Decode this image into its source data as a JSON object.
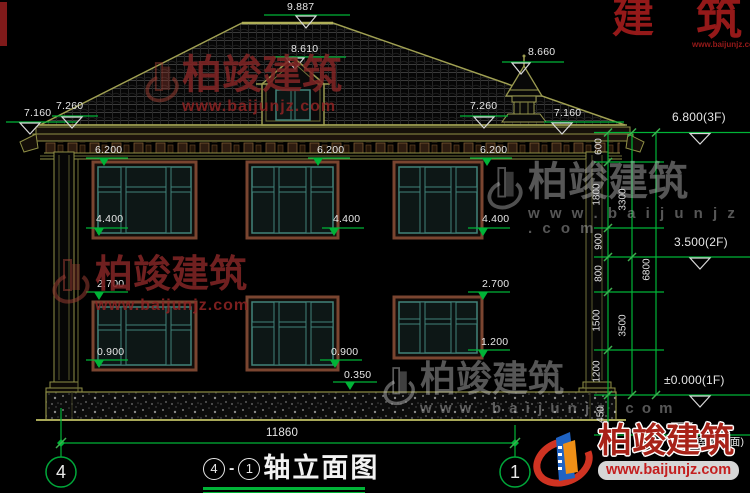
{
  "levels": {
    "ridge": "9.887",
    "dormer": "8.610",
    "turret": "8.660",
    "left_outer": "7.160",
    "left_inner": "7.260",
    "right_inner": "7.260",
    "right_outer": "7.160",
    "f3": "6.800(3F)",
    "f2": "3.500(2F)",
    "f1": "±0.000(1F)",
    "outdoor": "(室外地面)"
  },
  "dims": {
    "head_2f": [
      "6.200",
      "6.200",
      "6.200"
    ],
    "sill_2f": [
      "4.400",
      "4.400",
      "4.400"
    ],
    "head_1f": [
      "2.700",
      "2.700"
    ],
    "sill_1f": [
      "0.900",
      "0.900"
    ],
    "sill_1f_right": "1.200",
    "step": "0.350",
    "total_width": "11860"
  },
  "chain": {
    "outer": [
      "600",
      "1800",
      "900",
      "800",
      "1500",
      "1200",
      "450"
    ],
    "middle": [
      "3300",
      "3500"
    ],
    "total": "6800"
  },
  "axes": {
    "left": "4",
    "right": "1"
  },
  "title": {
    "axis_from": "4",
    "dash": "-",
    "axis_to": "1",
    "text": "轴立面图"
  },
  "watermark": {
    "brand": "柏竣建筑",
    "url": "www.baijunjz.com",
    "url_spaced": "w w w . b a i j u n j z . c o m",
    "frag_a": "建",
    "frag_b": "筑"
  },
  "colors": {
    "dim_green": "#00b437",
    "cad_olive": "#90904a",
    "teal_window": "#41837a",
    "brand_red": "#a82218",
    "logo_blue": "#1f63c4",
    "logo_orange": "#ef8f16",
    "watermark_red": "#7c2424",
    "watermark_gray": "#bdbdbd"
  }
}
